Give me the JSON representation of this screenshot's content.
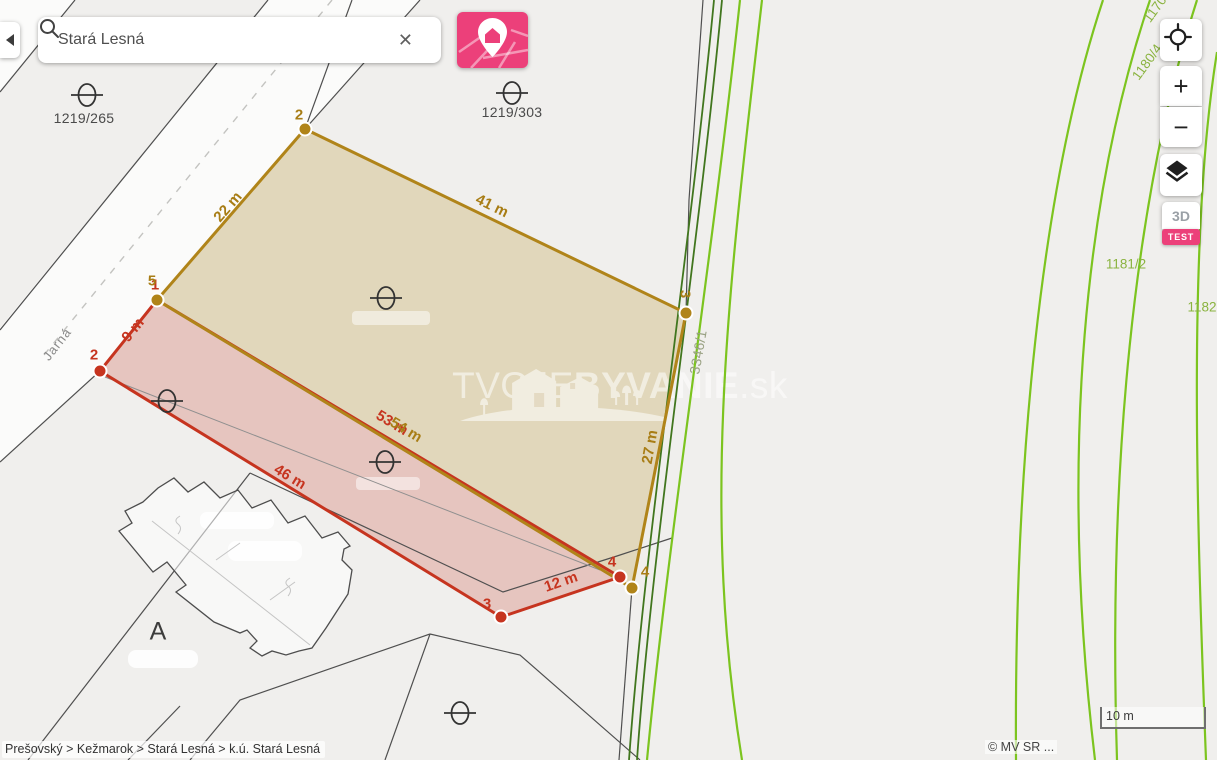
{
  "app": {
    "search": {
      "value": "Stará Lesná",
      "clear_icon": "✕"
    },
    "controls": {
      "zoom_in": "+",
      "zoom_out": "−",
      "three_d": "3D",
      "test_badge": "TEST"
    },
    "breadcrumb": "Prešovský > Kežmarok > Stará Lesná > k.ú. Stará Lesná",
    "scale_label": "10 m",
    "attribution": "© MV SR ..."
  },
  "map": {
    "street": "Jarná",
    "courtyard_symbol": "A",
    "watermark": {
      "light": "TVOJE",
      "bold": "BYVANIE",
      "tld": ".sk"
    },
    "parcel_labels": {
      "p1219_265": "1219/265",
      "p1219_303": "1219/303",
      "p3346_1": "3346/1",
      "p1180_4": "1180/4",
      "p1181_2": "1181/2",
      "p1182": "1182",
      "p1170": "1170"
    },
    "measurements": {
      "m22": "22 m",
      "m41": "41 m",
      "m27": "27 m",
      "m54": "54 m",
      "m9": "9 m",
      "m46": "46 m",
      "m12": "12 m",
      "m53": "53 m"
    },
    "vertices": {
      "g2": "2",
      "g3": "3",
      "g4": "4",
      "g5": "5",
      "r1": "1",
      "r2": "2",
      "r3": "3",
      "r4": "4"
    },
    "colors": {
      "gold": "#a87d15",
      "red": "#c6341f",
      "green_bright": "#7cc41f",
      "green_dark": "#41761e",
      "pink": "#ec407a"
    }
  }
}
